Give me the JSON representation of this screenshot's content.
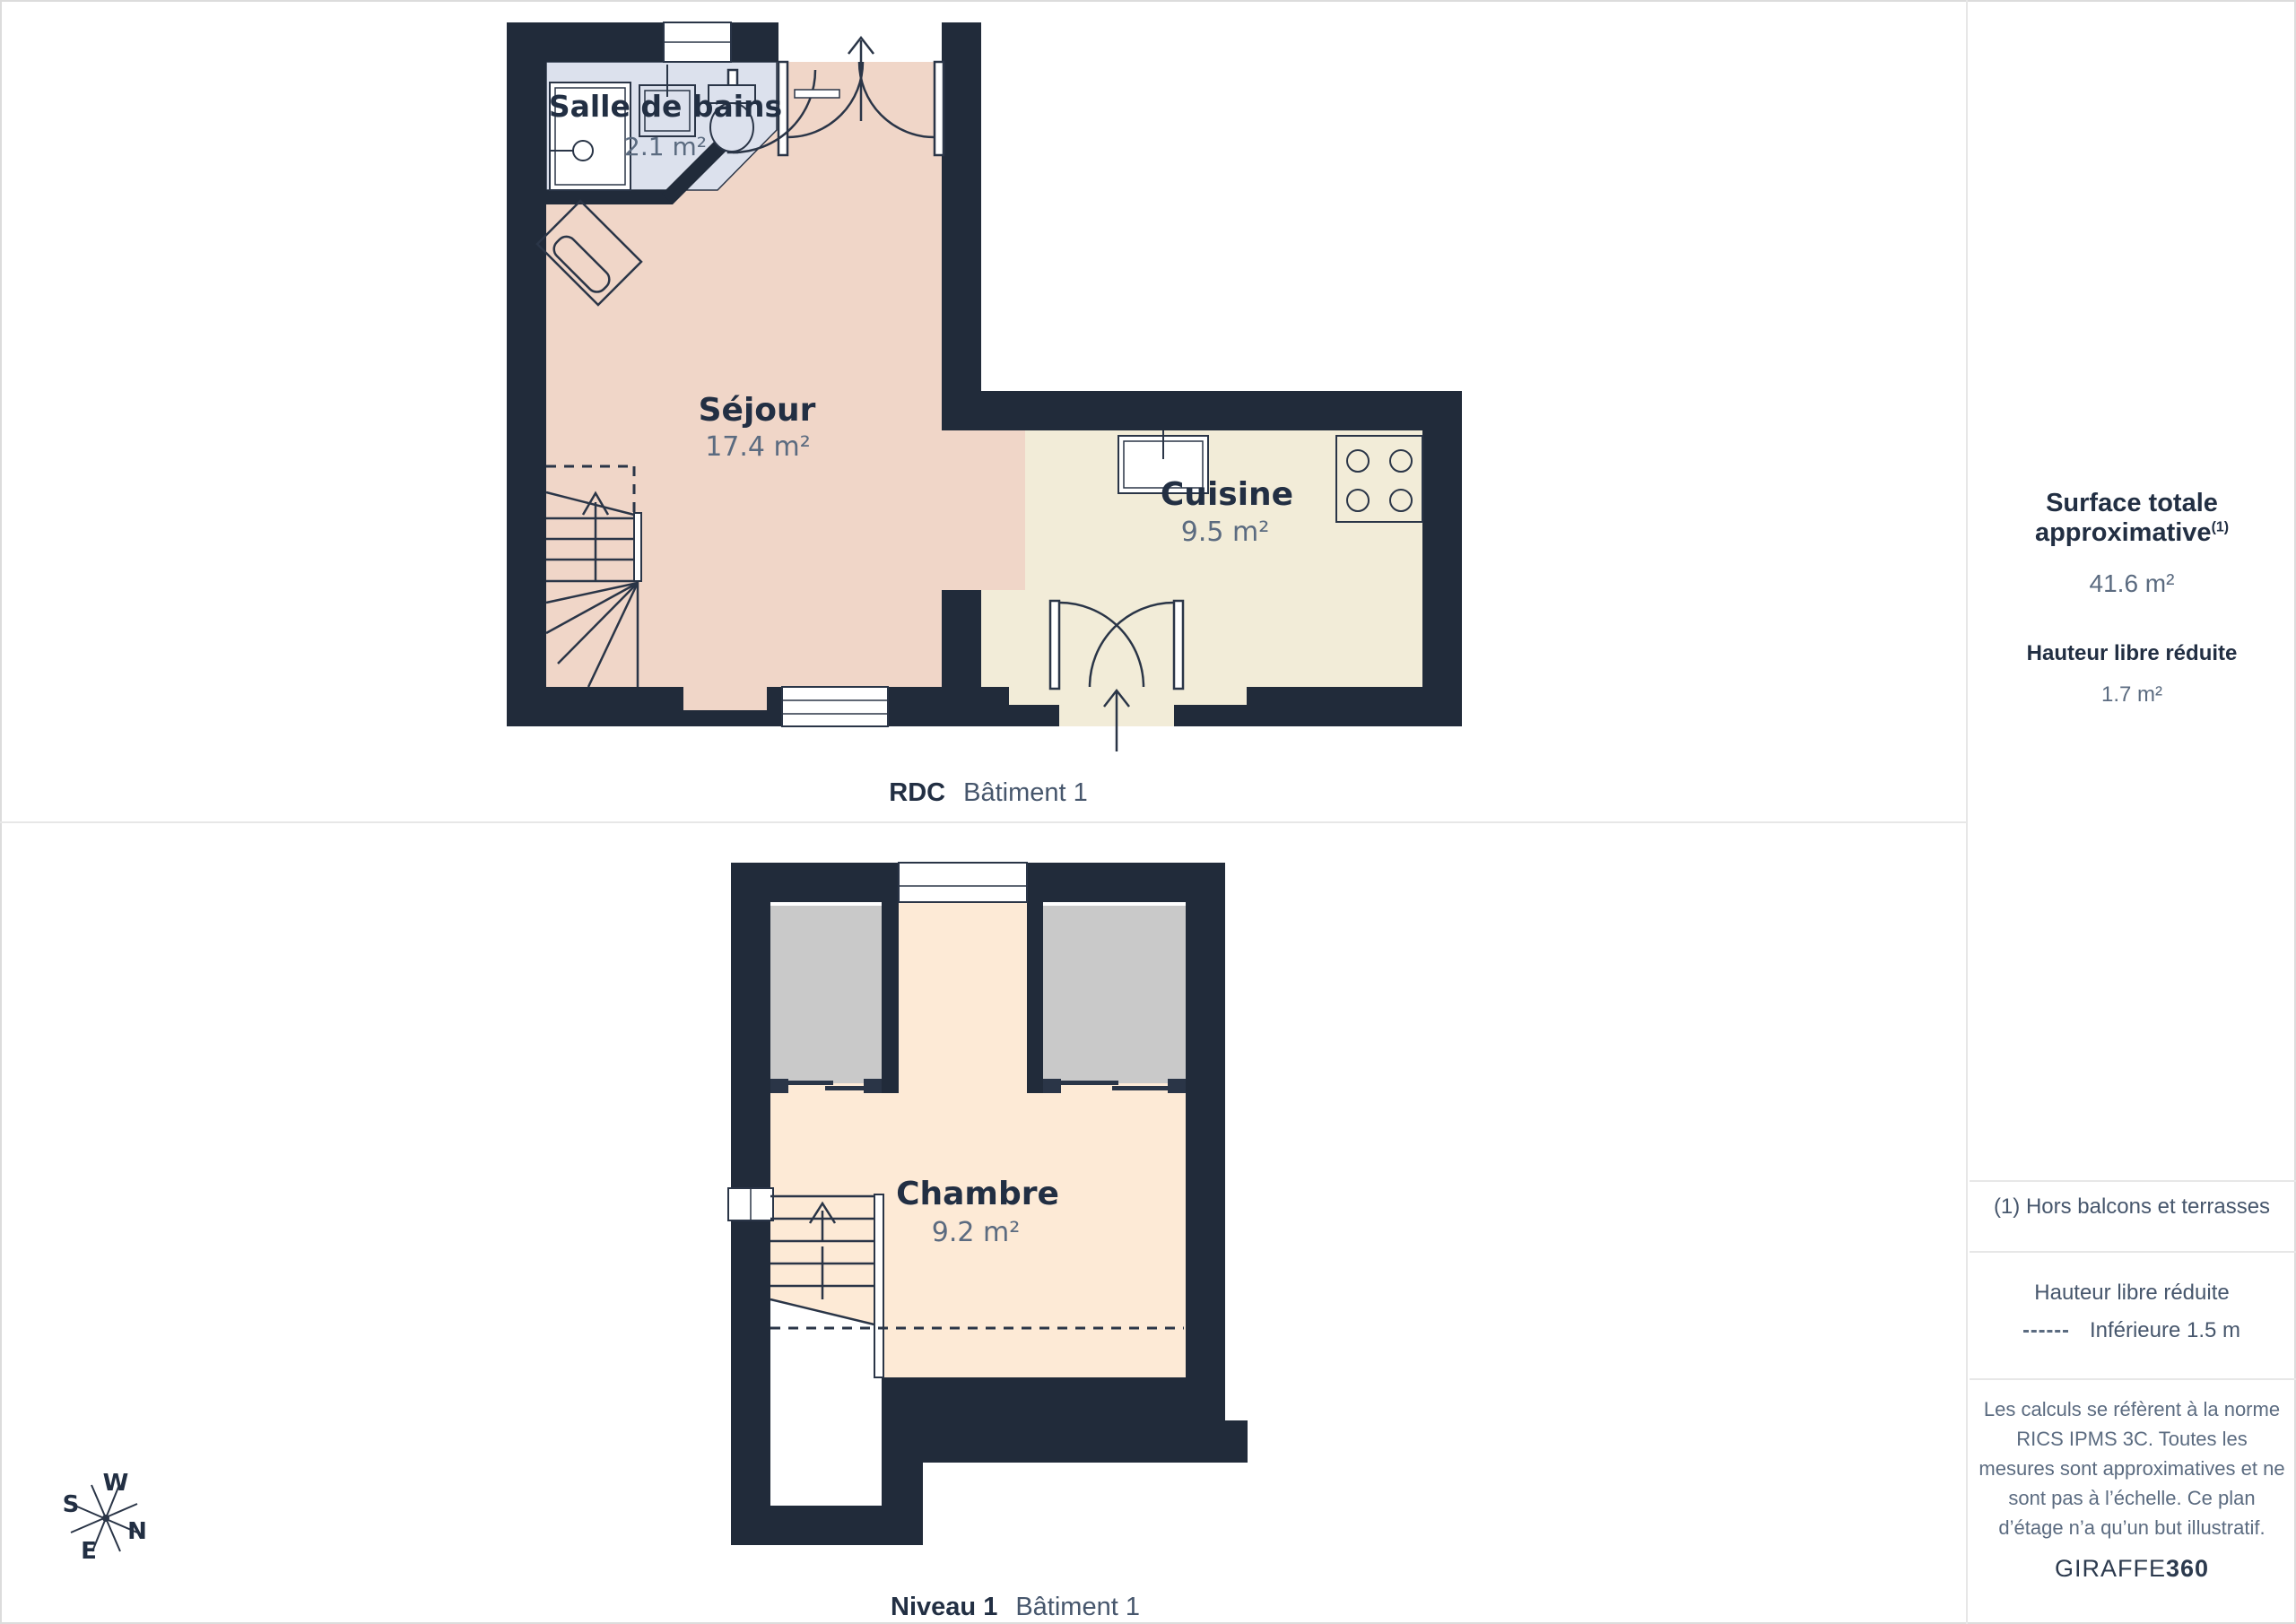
{
  "colors": {
    "wall": "#212b3a",
    "line": "#2a3547",
    "sejour_floor": "#f0d6c8",
    "bathroom_floor": "#dce1ed",
    "cuisine_floor": "#f2ecd8",
    "chambre_floor": "#fdead6",
    "closet_fill": "#c9c9c9",
    "label_navy": "#222f43",
    "value_slate": "#5b6b80",
    "divider": "#e7e7e7"
  },
  "floors": [
    {
      "id": "rdc",
      "caption_primary": "RDC",
      "caption_secondary": "Bâtiment 1",
      "rooms": [
        {
          "name": "Salle de bains",
          "area": "2.1 m²"
        },
        {
          "name": "Séjour",
          "area": "17.4 m²"
        },
        {
          "name": "Cuisine",
          "area": "9.5 m²"
        }
      ]
    },
    {
      "id": "niveau-1",
      "caption_primary": "Niveau 1",
      "caption_secondary": "Bâtiment 1",
      "rooms": [
        {
          "name": "Chambre",
          "area": "9.2 m²"
        }
      ]
    }
  ],
  "sidebar": {
    "total_area": {
      "label": "Surface totale approximative",
      "footnote_marker": "(1)",
      "value": "41.6 m²"
    },
    "reduced_height": {
      "label": "Hauteur libre réduite",
      "value": "1.7 m²"
    },
    "footnote": "(1) Hors balcons et terrasses",
    "legend": {
      "title": "Hauteur libre réduite",
      "entry": "Inférieure 1.5 m"
    },
    "disclaimer": "Les calculs se réfèrent à la norme RICS IPMS 3C. Toutes les mesures sont approximatives et ne sont pas à l’échelle. Ce plan d’étage n’a qu’un but illustratif.",
    "brand": {
      "name": "GIRAFFE",
      "suffix": "360"
    }
  },
  "compass": {
    "w": "W",
    "s": "S",
    "n": "N",
    "e": "E"
  }
}
